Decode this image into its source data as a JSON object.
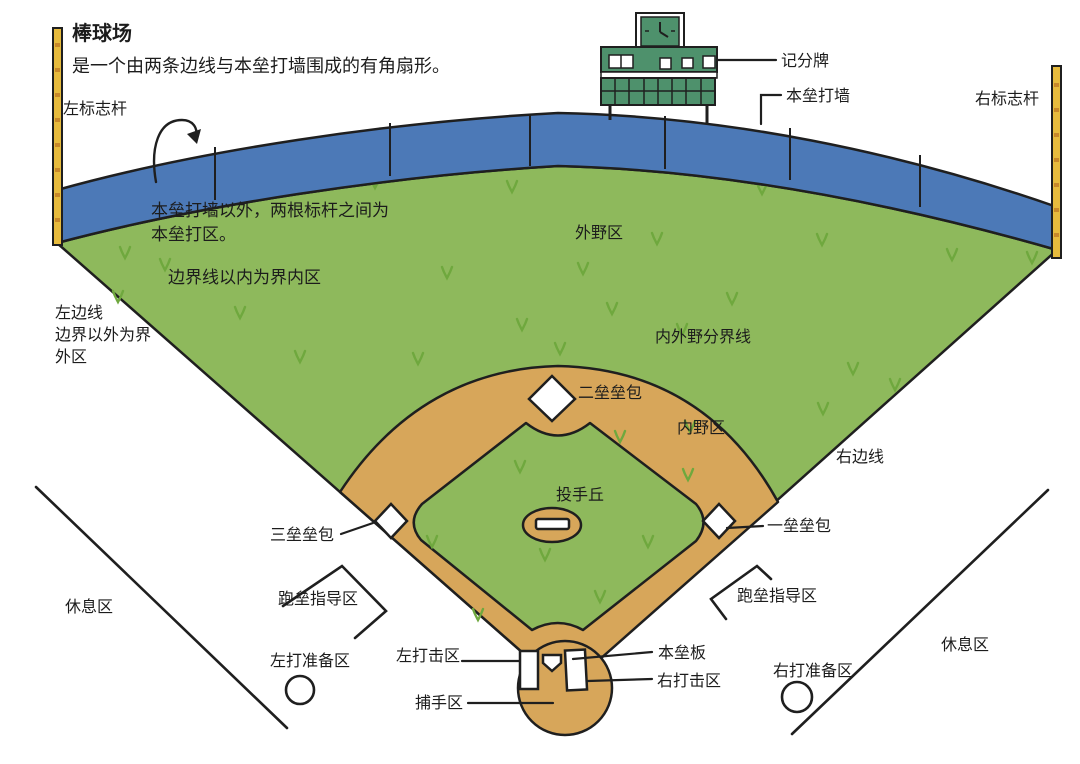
{
  "title_block": {
    "title": "棒球场",
    "subtitle": "是一个由两条边线与本垒打墙围成的有角扇形。"
  },
  "labels": {
    "left_pole": "左标志杆",
    "right_pole": "右标志杆",
    "scoreboard": "记分牌",
    "wall": "本垒打墙",
    "homerun_note_1": "本垒打墙以外，两根标杆之间为",
    "homerun_note_2": "本垒打区。",
    "fair_note": "边界线以内为界内区",
    "left_line": "左边线",
    "foul_note_1": "边界以外为界",
    "foul_note_2": "外区",
    "outfield": "外野区",
    "io_boundary": "内外野分界线",
    "right_line": "右边线",
    "second_base": "二垒垒包",
    "infield": "内野区",
    "pitcher_mound": "投手丘",
    "third_base": "三垒垒包",
    "first_base": "一垒垒包",
    "coach_box_left": "跑垒指导区",
    "coach_box_right": "跑垒指导区",
    "dugout_left": "休息区",
    "dugout_right": "休息区",
    "ondeck_left": "左打准备区",
    "ondeck_right": "右打准备区",
    "batter_left": "左打击区",
    "home_plate": "本垒板",
    "batter_right": "右打击区",
    "catcher": "捕手区"
  },
  "colors": {
    "field_green": "#8eb95c",
    "grass_tuft": "#6fa83e",
    "dirt_tan": "#d7a65a",
    "wall_blue": "#4c79b7",
    "pole_yellow": "#e7bb3d",
    "pole_stripe": "#c8882a",
    "scoreboard_green": "#4e916c",
    "outline": "#1f1f1f",
    "white": "#ffffff"
  }
}
